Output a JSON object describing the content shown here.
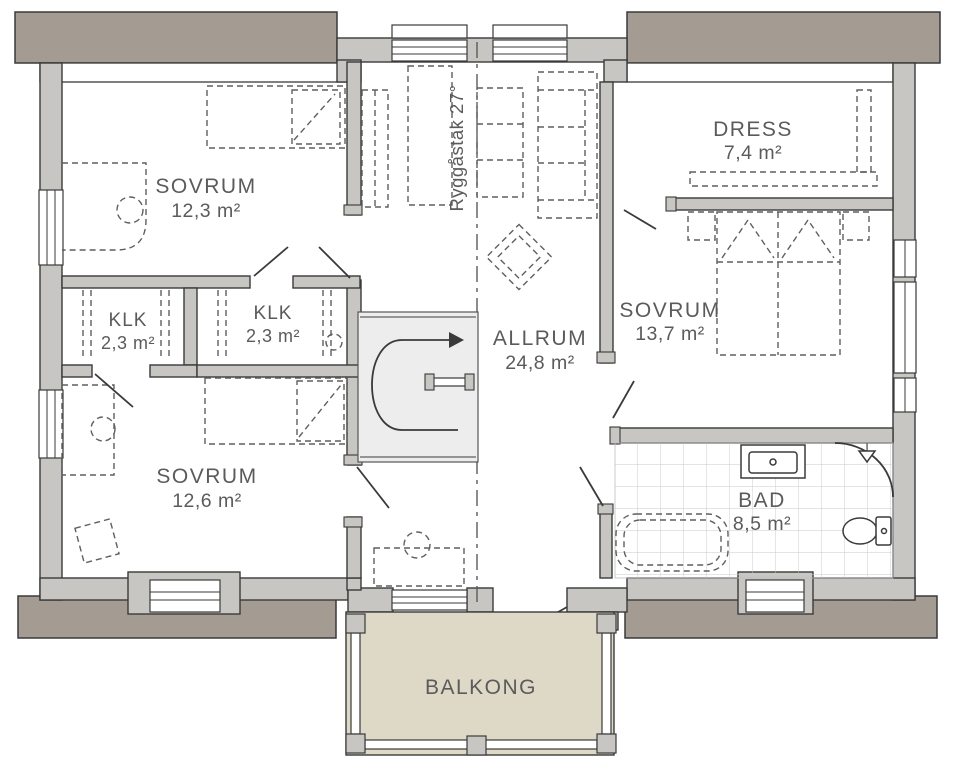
{
  "title": "Floor plan",
  "rooms": {
    "sovrum1": {
      "name": "SOVRUM",
      "area": "12,3 m²"
    },
    "klk1": {
      "name": "KLK",
      "area": "2,3 m²"
    },
    "klk2": {
      "name": "KLK",
      "area": "2,3 m²"
    },
    "sovrum2": {
      "name": "SOVRUM",
      "area": "12,6 m²"
    },
    "allrum": {
      "name": "ALLRUM",
      "area": "24,8 m²"
    },
    "dress": {
      "name": "DRESS",
      "area": "7,4 m²"
    },
    "sovrum3": {
      "name": "SOVRUM",
      "area": "13,7 m²"
    },
    "bad": {
      "name": "BAD",
      "area": "8,5 m²"
    },
    "balkong": {
      "name": "BALKONG"
    }
  },
  "annotations": {
    "ridge_label": "Ryggåstak 27°"
  },
  "colors": {
    "eave": "#a49b93",
    "wall": "#c7c6c3",
    "line": "#3a3a3a",
    "furn": "#5f5f5f",
    "label": "#5b5b5b",
    "tile": "#c9c9c9",
    "balcony": "#ded8c6",
    "stairFloor": "#ededed"
  }
}
